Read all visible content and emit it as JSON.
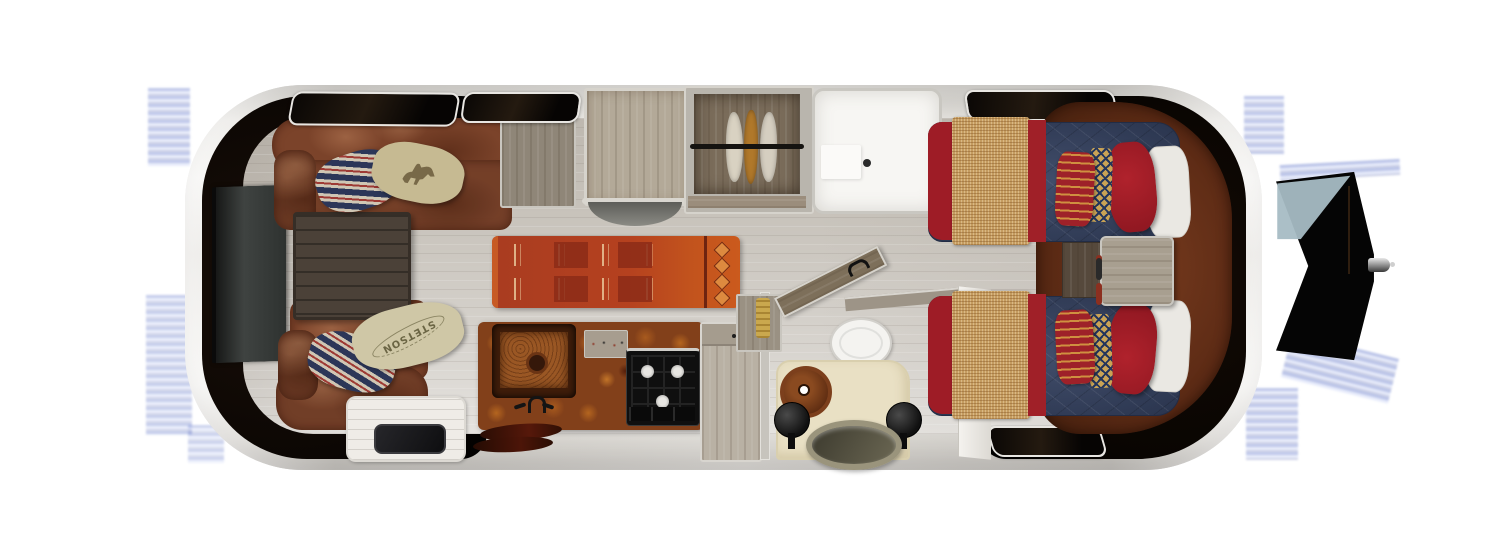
{
  "scene": {
    "type": "travel-trailer floor plan, top-down 3D render",
    "background_color": "#ffffff",
    "orientation": "hitch on right, rear lounge on left"
  },
  "labels": {
    "stetson_pillow": "STETSON"
  },
  "palette": {
    "shell_silver": "#e9e7e2",
    "interior_shadow": "#0c0704",
    "floor_wood": "#c7c2ba",
    "leather_sofa": "#7b432a",
    "headboard_leather": "#5d2b15",
    "cabinet_gray_wood": "#b3aa9c",
    "burl_counter": "#82401a",
    "copper_sink": "#9a5724",
    "cooktop_black": "#101010",
    "rug_red": "#b5411f",
    "bed_navy": "#33405f",
    "bed_red": "#9e1c26",
    "blanket_tan": "#c59c60",
    "pillow_stripe_navy": "#2c3658",
    "pillow_gold": "#c9a355",
    "shower_white": "#f7f6f3",
    "vanity_cream": "#e9e0c4",
    "artifact_blue": "#2447b0"
  },
  "rooms": {
    "rear_lounge": [
      "tv",
      "sectional-sofa",
      "coffee-table",
      "striped-pillows",
      "horse-print-pillow",
      "stetson-pillow",
      "end-cabinet"
    ],
    "galley": [
      "overhead-cabinet",
      "wheel-arch",
      "burl-counter",
      "copper-sink",
      "faucet",
      "spice-rack",
      "cooktop",
      "pantry-cabinet",
      "entry-step",
      "door-mat",
      "boots",
      "runner-rug"
    ],
    "wardrobe": [
      "hanging-rod",
      "garments"
    ],
    "shower": [
      "bench",
      "drain"
    ],
    "bathroom": [
      "door",
      "towel-shelf",
      "toilet",
      "half-wall-ledge",
      "vanity",
      "vessel-sink",
      "stools",
      "oval-basin",
      "white-wall"
    ],
    "bedroom": [
      "twin-bed-top",
      "twin-bed-bottom",
      "nightstand",
      "leather-headboard-wrap",
      "windows"
    ],
    "exterior": [
      "hitch-a-frame",
      "coupler",
      "compression-artifacts"
    ]
  }
}
